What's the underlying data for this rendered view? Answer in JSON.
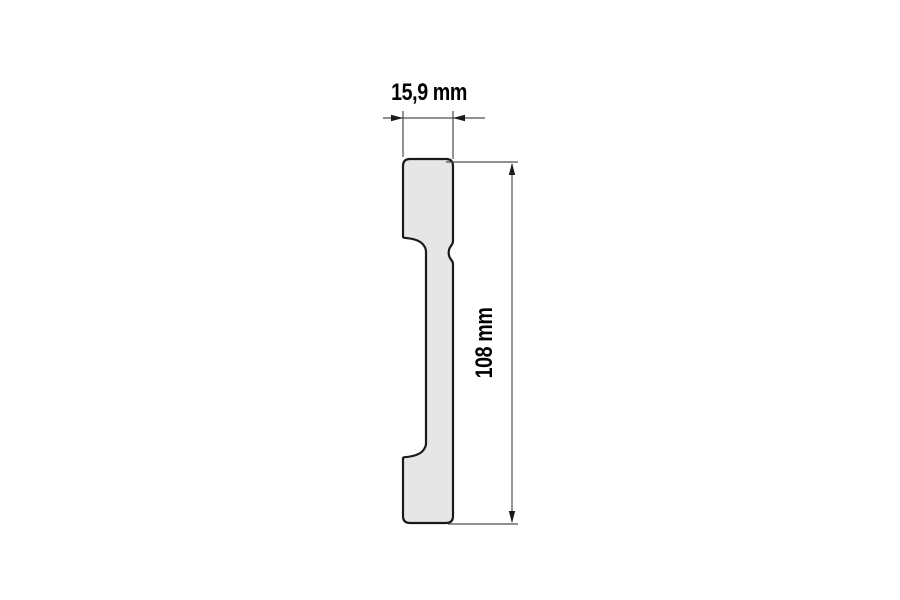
{
  "drawing": {
    "width_dimension": {
      "label": "15,9 mm"
    },
    "height_dimension": {
      "label": "108 mm"
    }
  },
  "colors": {
    "background": "#ffffff",
    "profile_fill": "#e6e6e6",
    "profile_outline": "#1a1a1a",
    "dimension_lines": "#4d4d4d",
    "dimension_text": "#000000"
  }
}
